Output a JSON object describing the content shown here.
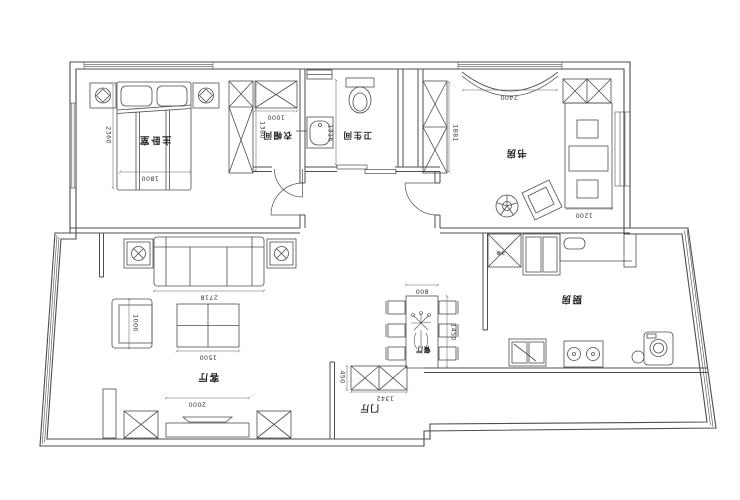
{
  "colors": {
    "line": "#4d4d4d",
    "text": "#2b2b2b",
    "background": "#ffffff"
  },
  "labels": {
    "master_bedroom": "主卧室",
    "cloakroom": "衣帽间",
    "bathroom": "卫生间",
    "study": "书房",
    "living_room": "客厅",
    "dining_room": "餐厅",
    "entry": "门厅",
    "kitchen": "厨房",
    "fridge": "冰箱"
  },
  "dimensions": {
    "bed_length": "2360",
    "bed_width": "1800",
    "cloak_wardrobe": "1000",
    "cloak_depth": "1380",
    "bathroom_width": "1316",
    "study_window": "2400",
    "study_cabinet": "1881",
    "desk": "1200",
    "sofa": "2718",
    "armchair": "1000",
    "coffee_table": "1500",
    "tv_wall": "2000",
    "dining_width": "800",
    "dining_length": "1450",
    "shoe_cabinet": "1342",
    "shoe_depth": "450"
  }
}
